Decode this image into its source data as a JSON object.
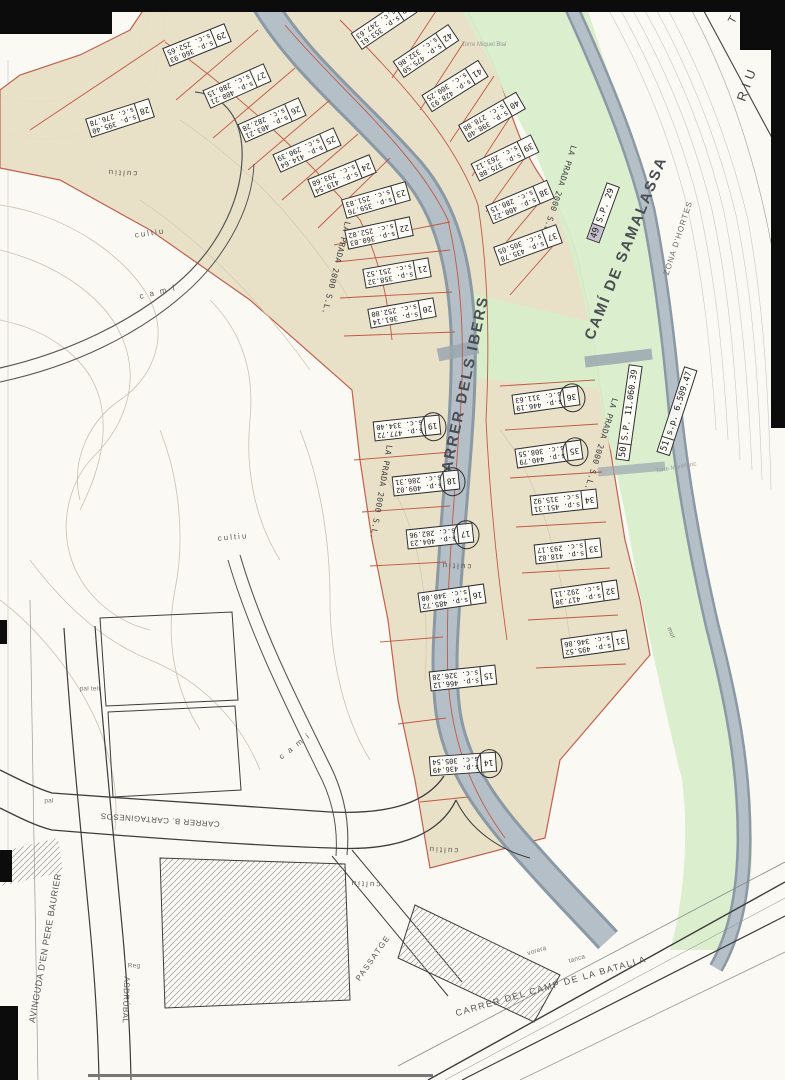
{
  "streets": {
    "ibers": "CARRER DELS IBERS",
    "samalassa": "CAMÍ DE SAMALASSA",
    "batalla": "CARRER DEL CAMP DE LA BATALLA",
    "cartaginesos": "CARRER B. CARTAGINESOS",
    "baurier": "AVINGUDA D'EN PERE BAURIER",
    "asdrubal": "ASDRÚBAL",
    "passatge": "PASSATGE",
    "riu": "RIU",
    "riu_t": "T"
  },
  "areas": {
    "zona_dhortes": "ZONA D'HORTES",
    "developer": "LA PRADA 2000 S.L.",
    "cultiu": "cultiu",
    "cami": "c a m í"
  },
  "features": {
    "pal": "pal",
    "pal_telf": "pal telf",
    "reg": "Reg",
    "tanca": "tanca",
    "vorera": "vorera",
    "mur": "mur",
    "torre_miquel": "Torre Miquel Bial",
    "torre_marib": "Torre Mariblanc"
  },
  "plots": [
    {
      "num": "29",
      "sp": "s.p. 360.93",
      "sc": "s.c. 252.65",
      "circled": false
    },
    {
      "num": "28",
      "sp": "s.p. 395.40",
      "sc": "s.c. 276.78",
      "circled": false
    },
    {
      "num": "27",
      "sp": "s.p. 400.21",
      "sc": "s.c. 280.15",
      "circled": false
    },
    {
      "num": "26",
      "sp": "s.p. 403.21",
      "sc": "s.c. 282.28",
      "circled": false
    },
    {
      "num": "25",
      "sp": "s.p. 414.64",
      "sc": "s.c. 290.39",
      "circled": false
    },
    {
      "num": "24",
      "sp": "s.p. 419.54",
      "sc": "s.c. 293.68",
      "circled": false
    },
    {
      "num": "23",
      "sp": "s.p. 359.76",
      "sc": "s.c. 251.83",
      "circled": false
    },
    {
      "num": "22",
      "sp": "s.p. 360.03",
      "sc": "s.c. 252.02",
      "circled": false
    },
    {
      "num": "21",
      "sp": "s.p. 358.32",
      "sc": "s.c. 251.52",
      "circled": false
    },
    {
      "num": "20",
      "sp": "s.p. 361.14",
      "sc": "s.c. 252.80",
      "circled": false
    },
    {
      "num": "19",
      "sp": "s.p. 477.72",
      "sc": "s.c. 334.40",
      "circled": true
    },
    {
      "num": "18",
      "sp": "s.p. 409.02",
      "sc": "s.c. 286.31",
      "circled": true
    },
    {
      "num": "17",
      "sp": "s.p. 404.23",
      "sc": "s.c. 282.96",
      "circled": true
    },
    {
      "num": "16",
      "sp": "s.p. 485.72",
      "sc": "s.c. 340.00",
      "circled": false
    },
    {
      "num": "15",
      "sp": "s.p. 466.12",
      "sc": "s.c. 326.28",
      "circled": false
    },
    {
      "num": "14",
      "sp": "s.p. 436.49",
      "sc": "s.c. 305.54",
      "circled": true
    },
    {
      "num": "43",
      "sp": "s.p. 353.61",
      "sc": "s.c. 247.63",
      "circled": false
    },
    {
      "num": "42",
      "sp": "s.p. 475.50",
      "sc": "s.c. 332.86",
      "circled": false
    },
    {
      "num": "41",
      "sp": "s.p. 428.93",
      "sc": "s.c. 300.25",
      "circled": false
    },
    {
      "num": "40",
      "sp": "s.p. 398.40",
      "sc": "s.c. 278.88",
      "circled": false
    },
    {
      "num": "39",
      "sp": "s.p. 375.88",
      "sc": "s.c. 263.12",
      "circled": false
    },
    {
      "num": "38",
      "sp": "s.p. 400.22",
      "sc": "s.c. 280.15",
      "circled": false
    },
    {
      "num": "37",
      "sp": "s.p. 435.78",
      "sc": "s.c. 305.05",
      "circled": false
    },
    {
      "num": "36",
      "sp": "s.p. 446.19",
      "sc": "s.c. 311.63",
      "circled": true
    },
    {
      "num": "35",
      "sp": "s.p. 440.79",
      "sc": "s.c. 308.55",
      "circled": true
    },
    {
      "num": "34",
      "sp": "s.p. 451.31",
      "sc": "s.c. 315.92",
      "circled": false
    },
    {
      "num": "33",
      "sp": "s.p. 418.82",
      "sc": "s.c. 293.17",
      "circled": false
    },
    {
      "num": "32",
      "sp": "s.p. 417.30",
      "sc": "s.c. 292.11",
      "circled": false
    },
    {
      "num": "31",
      "sp": "s.p. 495.52",
      "sc": "s.c. 346.86",
      "circled": false
    }
  ],
  "special": [
    {
      "num": "49",
      "area": "S.P. 29"
    },
    {
      "num": "50",
      "area": "S.P. 11.060.39"
    },
    {
      "num": "51",
      "area": "s.p. 6.509.47"
    }
  ],
  "colors": {
    "parcel_zone": "#e9dfc6",
    "green_zone": "#d9edcb",
    "road": "#aeb9c2",
    "boundary_red": "#c05844",
    "ink": "#3c3c3c"
  }
}
